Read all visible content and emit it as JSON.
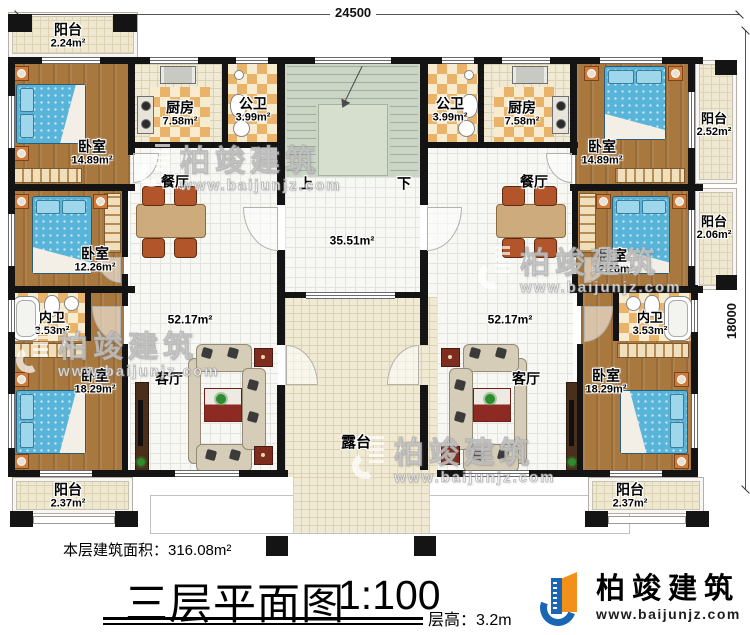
{
  "dimensions": {
    "top": "24500",
    "right": "18000"
  },
  "stairs": {
    "up": "上",
    "down": "下"
  },
  "halls": {
    "stair_hall_area": "35.51m²"
  },
  "rooms": {
    "balcony_tl": {
      "name": "阳台",
      "area": "2.24m²"
    },
    "bedroom1_l": {
      "name": "卧室",
      "area": "14.89m²"
    },
    "kitchen_l": {
      "name": "厨房",
      "area": "7.58m²"
    },
    "pubbath_l": {
      "name": "公卫",
      "area": "3.99m²"
    },
    "dining_l": {
      "name": "餐厅",
      "area": ""
    },
    "bedroom2_l": {
      "name": "卧室",
      "area": "12.26m²"
    },
    "innerbath_l": {
      "name": "内卫",
      "area": "3.53m²"
    },
    "bedroom3_l": {
      "name": "卧室",
      "area": "18.29m²"
    },
    "living_l": {
      "name": "客厅",
      "area": "52.17m²"
    },
    "balcony_bl": {
      "name": "阳台",
      "area": "2.37m²"
    },
    "pubbath_r": {
      "name": "公卫",
      "area": "3.99m²"
    },
    "kitchen_r": {
      "name": "厨房",
      "area": "7.58m²"
    },
    "bedroom1_r": {
      "name": "卧室",
      "area": "14.89m²"
    },
    "balcony_r1": {
      "name": "阳台",
      "area": "2.52m²"
    },
    "bedroom2_r": {
      "name": "卧室",
      "area": "12.26m²"
    },
    "balcony_r2": {
      "name": "阳台",
      "area": "2.06m²"
    },
    "dining_r": {
      "name": "餐厅",
      "area": ""
    },
    "living_r": {
      "name": "客厅",
      "area": "52.17m²"
    },
    "innerbath_r": {
      "name": "内卫",
      "area": "3.53m²"
    },
    "bedroom3_r": {
      "name": "卧室",
      "area": "18.29m²"
    },
    "balcony_br": {
      "name": "阳台",
      "area": "2.37m²"
    },
    "terrace": {
      "name": "露台"
    }
  },
  "footer": {
    "floor_area": "本层建筑面积：316.08m²",
    "title": "三层平面图",
    "scale": "1:100",
    "floor_height": "层高：3.2m",
    "logo_name": "柏竣建筑",
    "logo_url": "www.baijunjz.com"
  },
  "watermark": {
    "name": "柏竣建筑",
    "url": "www.baijunjz.com"
  },
  "colors": {
    "wall": "#141414",
    "wood_floor": "#a8783f",
    "bed_blue": "#58b4d8",
    "tile_checker": "#e9b469",
    "stair_green": "#cbd5c6",
    "terrace_cream": "#efe8d1",
    "logo_blue": "#1a66b5",
    "logo_orange": "#f39019"
  }
}
